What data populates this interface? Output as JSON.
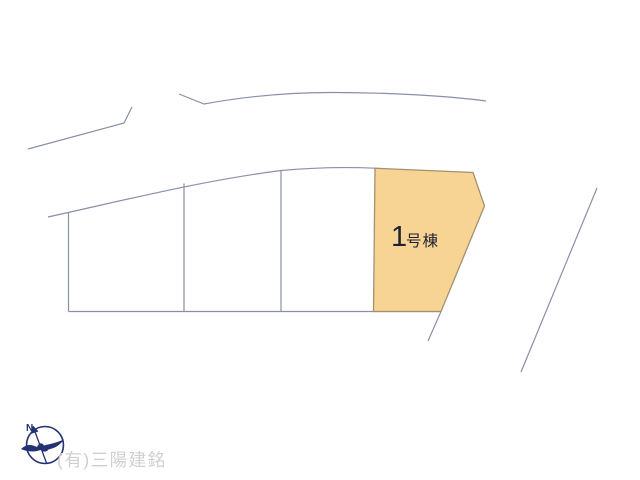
{
  "page": {
    "background": "#ffffff"
  },
  "plan": {
    "lot_label": {
      "number": "1",
      "suffix": "号棟"
    },
    "colors": {
      "line": "#8a8fa8",
      "lot_fill": "#f8d494",
      "lot_stroke": "#a3906f",
      "label_text": "#1d2133"
    }
  },
  "compass": {
    "north_label": "N",
    "color": "#223273"
  },
  "footer": {
    "company": "(有)三陽建銘",
    "color": "#cfcfcf"
  }
}
